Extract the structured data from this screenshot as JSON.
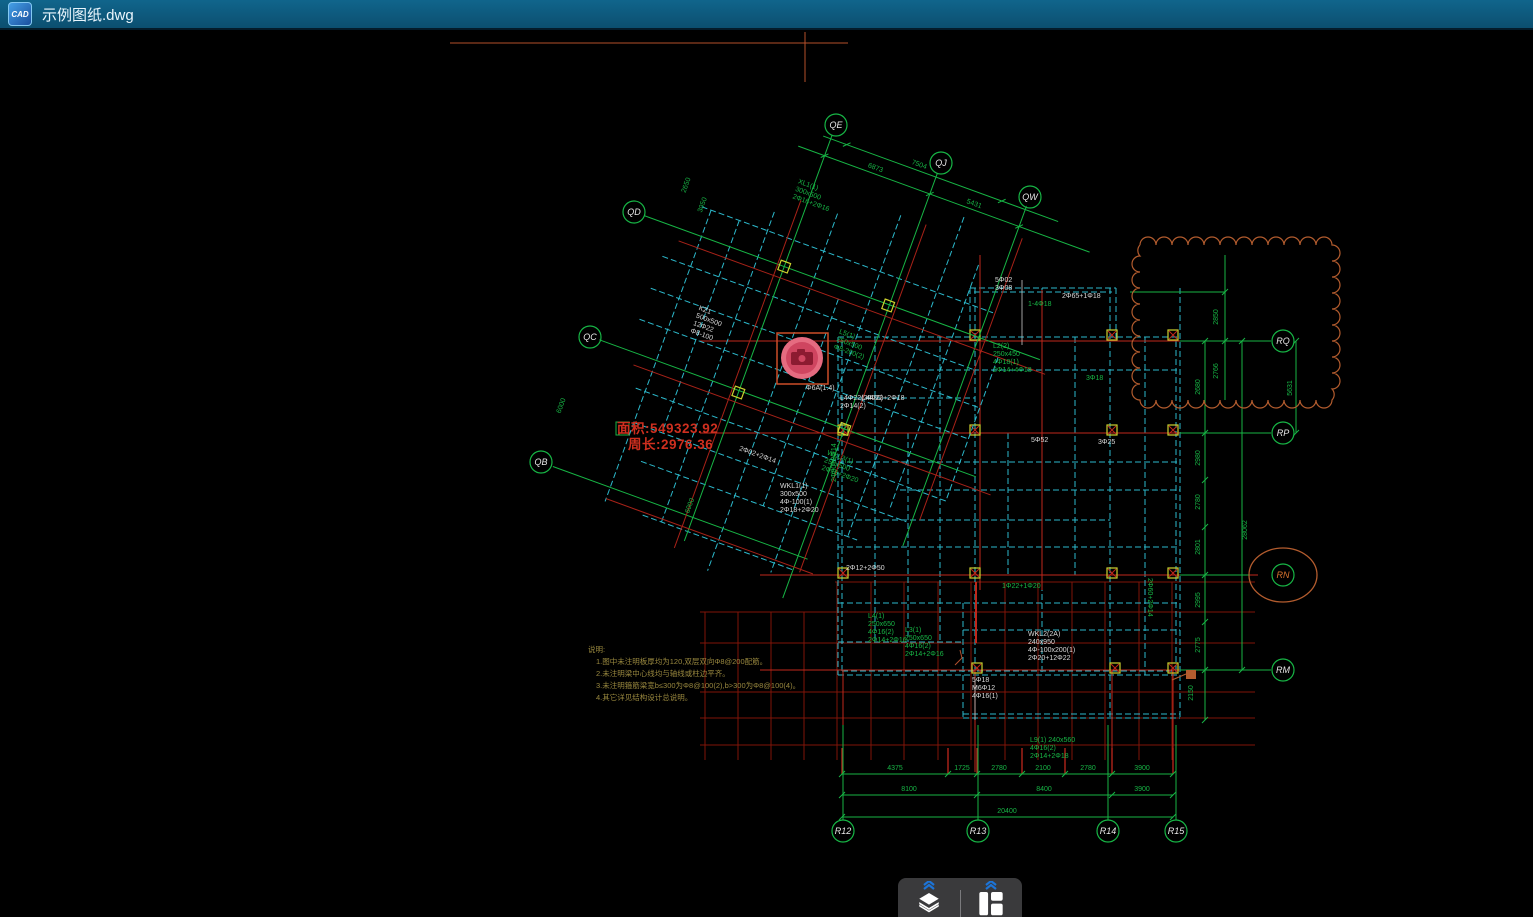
{
  "window": {
    "title": "示例图纸.dwg",
    "icon_text": "CAD"
  },
  "measurements": {
    "area": "面积:549323.92",
    "perimeter": "周长:2976.36"
  },
  "notes": {
    "title": "说明:",
    "lines": [
      "1.图中未注明板厚均为120,双层双向Φ8@200配筋。",
      "2.未注明梁中心线均与轴线或柱边平齐。",
      "3.未注明箍筋梁宽b≤300为Φ8@100(2),b>300为Φ8@100(4)。",
      "4.其它详见结构设计总说明。"
    ]
  },
  "bubbles": {
    "qe": "QE",
    "qj": "QJ",
    "qw": "QW",
    "qd": "QD",
    "qc": "QC",
    "qb": "QB",
    "rq": "RQ",
    "rp": "RP",
    "rn": "RN",
    "rm": "RM",
    "r12": "R12",
    "r13": "R13",
    "r14": "R14",
    "r15": "R15"
  },
  "dims": {
    "bottom1": [
      "4375",
      "1725",
      "2780",
      "2100",
      "2780",
      "3900"
    ],
    "bottom2": [
      "8100",
      "8400",
      "3900"
    ],
    "bottom3": [
      "20400"
    ],
    "right": [
      "2850",
      "2766",
      "5631",
      "2680",
      "2980",
      "2780",
      "2801",
      "2995",
      "2775",
      "2150"
    ],
    "right_total": "28062",
    "top_diag": [
      "6873",
      "7504",
      "5431"
    ],
    "left_diag": [
      "2650",
      "3050",
      "6000",
      "6000"
    ]
  },
  "labels": {
    "g_l2": [
      "L2(2)",
      "250x450",
      "4Φ18(1)",
      "2Φ14+4Φ18"
    ],
    "g_l4": [
      "L4(1)",
      "250x650",
      "4Φ16(2)",
      "2Φ14+2Φ16"
    ],
    "g_l3": [
      "L3(1)",
      "250x650",
      "4Φ16(2)",
      "2Φ14+2Φ16"
    ],
    "g_l9": [
      "L9(1) 240x560",
      "4Φ16(2)",
      "2Φ14+2Φ18"
    ],
    "g_b1": "1Φ22+1Φ20",
    "g_b2": "3Φ18",
    "g_b3": "1-4Φ18",
    "g_b4": "2Φ60+2Φ14",
    "g_b5": "2Φ80+2Φ14",
    "w_wkl2": [
      "WKL2(2A)",
      "240x950",
      "4Φ-100x200(1)",
      "2Φ20+12Φ22"
    ],
    "w_wkl1": [
      "WKL1(1)",
      "300x500",
      "4Φ-100(1)",
      "2Φ18+2Φ20"
    ],
    "w_s1": "2Φ12+2Φ50",
    "w_s2": "L4Φ22+2Φ18",
    "w_s3": "5Φ52",
    "w_s4": "3Φ25",
    "w_s5": [
      "5Φ18",
      "M6Φ12",
      "4Φ16(1)"
    ],
    "w_s6": "2Φ65+1Φ18",
    "w_s7": "Φ6A(1.4)",
    "w_s9": [
      "5Φ02",
      "3Φ08"
    ],
    "w_cam": [
      "L4Φ22(2Φ20)",
      "2Φ14(2)"
    ],
    "wing_g1": [
      "XL1(1)",
      "300x500",
      "2Φ16+2Φ16"
    ],
    "wing_g2": [
      "L5(1)",
      "250x500",
      "Φ8-200(2)"
    ],
    "wing_w1": [
      "KZ1",
      "500x500",
      "12Φ22",
      "Φ8-100"
    ],
    "wing_g3": [
      "WKL3(1)",
      "250x500",
      "2Φ18+2Φ20"
    ],
    "wing_w2": "2Φ02+2Φ14"
  },
  "colors": {
    "green": "#17b545",
    "cyan": "#2cb9cc",
    "red_bright": "#c0271b",
    "red_dark": "#801509",
    "yellow": "#cdd22e",
    "orange": "#b35c2e",
    "titlebar": "#0e5a7c",
    "camera_pink": "#e56b80"
  },
  "toolbar": {
    "icons": [
      "layers-icon",
      "layout-icon"
    ]
  }
}
